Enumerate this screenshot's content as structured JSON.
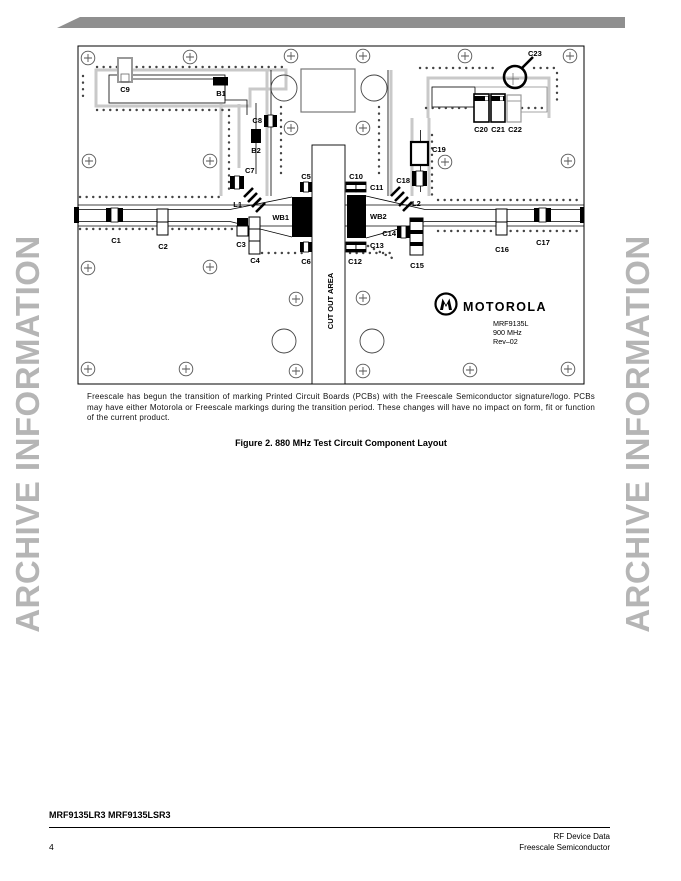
{
  "colors": {
    "banner": "#8f8f8f",
    "watermark": "#b5b5b5",
    "board_outline": "#000000"
  },
  "watermark": {
    "text": "ARCHIVE INFORMATION"
  },
  "board": {
    "labels": {
      "c1": "C1",
      "c2": "C2",
      "c3": "C3",
      "c4": "C4",
      "c5": "C5",
      "c6": "C6",
      "c7": "C7",
      "c8": "C8",
      "c9": "C9",
      "c10": "C10",
      "c11": "C11",
      "c12": "C12",
      "c13": "C13",
      "c14": "C14",
      "c15": "C15",
      "c16": "C16",
      "c17": "C17",
      "c18": "C18",
      "c19": "C19",
      "c20": "C20",
      "c21": "C21",
      "c22": "C22",
      "c23": "C23",
      "b1": "B1",
      "b2": "B2",
      "l1": "L1",
      "l2": "L2",
      "wb1": "WB1",
      "wb2": "WB2"
    },
    "cut_out": "CUT OUT AREA",
    "logo": {
      "brand": "MOTOROLA",
      "part": "MRF9135L",
      "freq": "900 MHz",
      "rev": "Rev–02"
    }
  },
  "note": "Freescale has begun the transition of marking Printed Circuit Boards (PCBs) with the Freescale Semiconductor signature/logo. PCBs may have either Motorola or Freescale markings during the transition period. These changes will have no impact on form, fit or function of the current product.",
  "caption": "Figure 2. 880 MHz Test Circuit Component Layout",
  "footer": {
    "part_numbers": "MRF9135LR3 MRF9135LSR3",
    "page_number": "4",
    "line1": "RF Device Data",
    "line2": "Freescale Semiconductor"
  }
}
